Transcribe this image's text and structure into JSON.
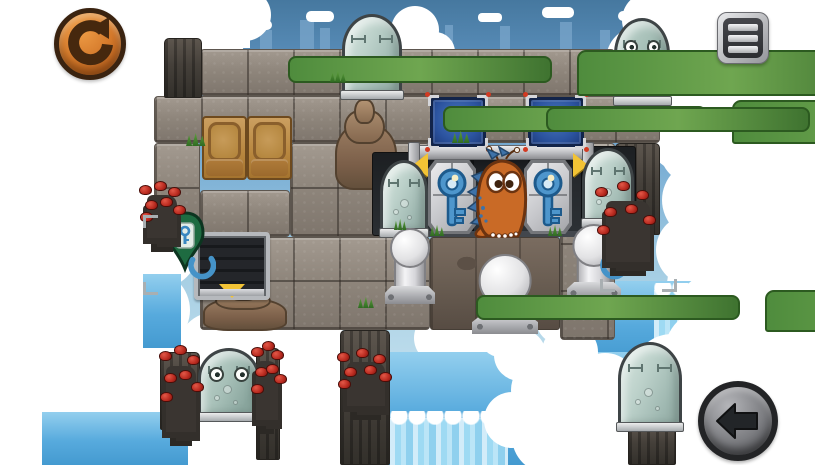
{
  "ui": {
    "restart_button": {
      "icon": "rotate-ccw-icon",
      "action": "restart-level"
    },
    "menu_button": {
      "icon": "hamburger-icon",
      "action": "open-menu"
    },
    "back_button": {
      "icon": "arrow-left-icon",
      "action": "go-back"
    }
  },
  "palette": {
    "sky_top": "#46789f",
    "sky_low": "#c6e2ef",
    "cloud": "#ffffff",
    "water": "#57aadd",
    "waterfall": "#9edaf3",
    "stone": "#8f867c",
    "dark_rock": "#45403a",
    "crate": "#b8873f",
    "metal": "#c6c7cb",
    "panel_blue": "#2c54a0",
    "key_blue": "#4e96cc",
    "pin_green": "#1e6b41",
    "arrow_yellow": "#f2c335",
    "character_orange": "#c96a26",
    "berry_red": "#ba2b20",
    "restart_orange": "#d3782a",
    "button_gray": "#7c7d81"
  },
  "scene": {
    "entities": [
      {
        "t": "water",
        "x": 143,
        "y": 274,
        "w": 38,
        "h": 74
      },
      {
        "t": "water",
        "x": 42,
        "y": 412,
        "w": 146,
        "h": 53
      },
      {
        "t": "water",
        "x": 545,
        "y": 281,
        "w": 160,
        "h": 80
      },
      {
        "t": "water",
        "x": 348,
        "y": 352,
        "w": 357,
        "h": 113
      },
      {
        "t": "waterfall",
        "x": 390,
        "y": 418,
        "w": 118,
        "h": 47
      },
      {
        "t": "waterfall",
        "x": 654,
        "y": 290,
        "w": 48,
        "h": 156
      },
      {
        "t": "stone",
        "x": 200,
        "y": 49,
        "w": 415,
        "h": 47
      },
      {
        "t": "stone",
        "x": 154,
        "y": 96,
        "w": 506,
        "h": 47
      },
      {
        "t": "stone",
        "x": 154,
        "y": 143,
        "w": 46,
        "h": 94
      },
      {
        "t": "stone",
        "x": 290,
        "y": 143,
        "w": 140,
        "h": 94
      },
      {
        "t": "stone",
        "x": 200,
        "y": 190,
        "w": 90,
        "h": 47
      },
      {
        "t": "stone",
        "x": 200,
        "y": 237,
        "w": 230,
        "h": 93
      },
      {
        "t": "rocky",
        "x": 430,
        "y": 237,
        "w": 130,
        "h": 93
      },
      {
        "t": "stone",
        "x": 560,
        "y": 143,
        "w": 55,
        "h": 197
      },
      {
        "t": "darkrock",
        "x": 615,
        "y": 143,
        "w": 45,
        "h": 92
      },
      {
        "t": "darkrock",
        "x": 340,
        "y": 330,
        "w": 50,
        "h": 135
      },
      {
        "t": "darkrock",
        "x": 160,
        "y": 352,
        "w": 40,
        "h": 78
      },
      {
        "t": "darkrock",
        "x": 256,
        "y": 348,
        "w": 24,
        "h": 112
      },
      {
        "t": "darkrock",
        "x": 628,
        "y": 424,
        "w": 48,
        "h": 41
      },
      {
        "t": "darkrock",
        "x": 164,
        "y": 38,
        "w": 38,
        "h": 60
      },
      {
        "t": "rockpile",
        "x": 335,
        "y": 124,
        "w": 62,
        "h": 66
      },
      {
        "t": "rockpile",
        "x": 203,
        "y": 298,
        "w": 84,
        "h": 33
      },
      {
        "t": "recess",
        "x": 372,
        "y": 152,
        "w": 60,
        "h": 84
      },
      {
        "t": "recess",
        "x": 578,
        "y": 146,
        "w": 58,
        "h": 82
      },
      {
        "t": "bay",
        "x": 419,
        "y": 157,
        "w": 164,
        "h": 80
      },
      {
        "t": "metaltile",
        "x": 428,
        "y": 160,
        "w": 48,
        "h": 74
      },
      {
        "t": "metaltile",
        "x": 524,
        "y": 160,
        "w": 48,
        "h": 74
      },
      {
        "t": "rail",
        "x": 411,
        "y": 145,
        "w": 180,
        "h": 15
      },
      {
        "t": "yarrow",
        "x": 413,
        "y": 153,
        "dir": "left"
      },
      {
        "t": "yarrow",
        "x": 573,
        "y": 153,
        "dir": "right"
      },
      {
        "t": "bluepanel",
        "x": 430,
        "y": 97,
        "w": 56,
        "h": 50
      },
      {
        "t": "bluepanel",
        "x": 528,
        "y": 97,
        "w": 56,
        "h": 50
      },
      {
        "t": "crate",
        "x": 202,
        "y": 116,
        "w": 45,
        "h": 64
      },
      {
        "t": "crate",
        "x": 247,
        "y": 116,
        "w": 45,
        "h": 64
      },
      {
        "t": "door",
        "x": 194,
        "y": 232,
        "w": 76,
        "h": 68
      },
      {
        "t": "tube",
        "x": 342,
        "y": 14,
        "w": 60,
        "h": 84
      },
      {
        "t": "tube",
        "x": 614,
        "y": 18,
        "w": 56,
        "h": 86,
        "face": true
      },
      {
        "t": "tube",
        "x": 380,
        "y": 160,
        "w": 48,
        "h": 76
      },
      {
        "t": "tube",
        "x": 582,
        "y": 148,
        "w": 52,
        "h": 78
      },
      {
        "t": "tube",
        "x": 198,
        "y": 348,
        "w": 62,
        "h": 72,
        "face": true
      },
      {
        "t": "tube",
        "x": 618,
        "y": 342,
        "w": 64,
        "h": 88
      },
      {
        "t": "key",
        "x": 434,
        "y": 163,
        "w": 36,
        "h": 68
      },
      {
        "t": "key",
        "x": 530,
        "y": 163,
        "w": 36,
        "h": 68
      },
      {
        "t": "piston",
        "x": 385,
        "y": 228,
        "w": 50,
        "h": 76
      },
      {
        "t": "piston",
        "x": 567,
        "y": 224,
        "w": 54,
        "h": 76
      },
      {
        "t": "piston",
        "x": 472,
        "y": 254,
        "w": 66,
        "h": 80
      },
      {
        "t": "dino",
        "x": 466,
        "y": 146,
        "w": 72,
        "h": 92
      },
      {
        "t": "keypin",
        "x": 164,
        "y": 211,
        "w": 42,
        "h": 62
      },
      {
        "t": "keypin",
        "x": 612,
        "y": 211,
        "w": 42,
        "h": 62
      },
      {
        "t": "swirl",
        "x": 186,
        "y": 252,
        "w": 30,
        "h": 34
      },
      {
        "t": "swirl",
        "x": 598,
        "y": 252,
        "w": 30,
        "h": 34
      },
      {
        "t": "berries",
        "x": 138,
        "y": 183,
        "w": 48,
        "h": 55
      },
      {
        "t": "berries",
        "x": 594,
        "y": 184,
        "w": 68,
        "h": 78
      },
      {
        "t": "berries",
        "x": 158,
        "y": 348,
        "w": 46,
        "h": 84
      },
      {
        "t": "berries",
        "x": 250,
        "y": 344,
        "w": 34,
        "h": 76
      },
      {
        "t": "berries",
        "x": 336,
        "y": 350,
        "w": 60,
        "h": 56
      },
      {
        "t": "cactus",
        "x": 324,
        "y": 50,
        "w": 26,
        "h": 46
      },
      {
        "t": "cactus",
        "x": 479,
        "y": 100,
        "w": 26,
        "h": 44
      },
      {
        "t": "cactus",
        "x": 582,
        "y": 102,
        "w": 22,
        "h": 42
      },
      {
        "t": "cactus",
        "x": 512,
        "y": 290,
        "w": 26,
        "h": 42
      },
      {
        "t": "grass",
        "x": 186,
        "y": 132,
        "w": 22,
        "h": 14
      },
      {
        "t": "grass",
        "x": 330,
        "y": 70,
        "w": 18,
        "h": 12
      },
      {
        "t": "grass",
        "x": 452,
        "y": 130,
        "w": 20,
        "h": 13
      },
      {
        "t": "grass",
        "x": 430,
        "y": 224,
        "w": 16,
        "h": 12
      },
      {
        "t": "grass",
        "x": 548,
        "y": 224,
        "w": 16,
        "h": 12
      },
      {
        "t": "grass",
        "x": 358,
        "y": 296,
        "w": 18,
        "h": 12
      },
      {
        "t": "grass",
        "x": 394,
        "y": 218,
        "w": 14,
        "h": 12
      },
      {
        "t": "bracket",
        "x": 143,
        "y": 215,
        "dir": "tl"
      },
      {
        "t": "bracket",
        "x": 143,
        "y": 282,
        "dir": "bl"
      },
      {
        "t": "bracket",
        "x": 600,
        "y": 279,
        "dir": "bl"
      },
      {
        "t": "bracket",
        "x": 662,
        "y": 279,
        "dir": "br"
      }
    ]
  }
}
